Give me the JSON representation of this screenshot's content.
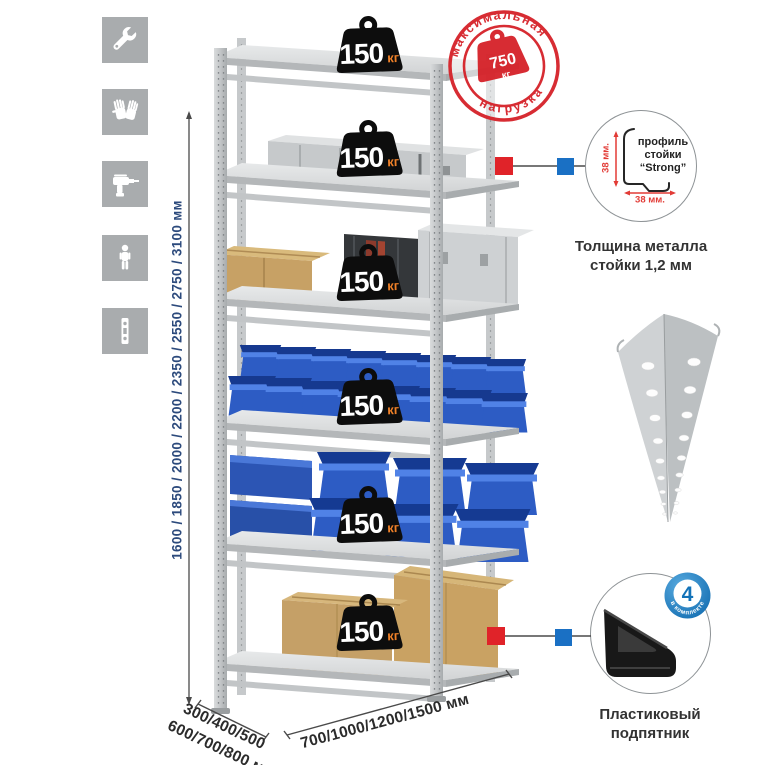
{
  "colors": {
    "accent-red": "#d6242b",
    "accent-blue": "#1a70c4",
    "dim-blue": "#2c4a7c",
    "badge-orange": "#f08128",
    "icon-gray": "#a9acae",
    "text-dark": "#333333"
  },
  "sidebar": {
    "icons": [
      "wrench",
      "gloves",
      "drill",
      "person-height",
      "perforated-profile"
    ]
  },
  "dimensions": {
    "height": "1600 / 1850 / 2000 / 2200 / 2350 / 2550 / 2750 / 3100 мм",
    "width": "700/1000/1200/1500 мм",
    "depth_line1": "300/400/500",
    "depth_line2": "600/700/800 мм"
  },
  "stamp": {
    "arc_top": "максимальная",
    "arc_bottom": "нагрузка",
    "weight_value": "750",
    "weight_unit": "кг"
  },
  "rack": {
    "shelf_loads": [
      {
        "value": "150",
        "unit": "кг"
      },
      {
        "value": "150",
        "unit": "кг"
      },
      {
        "value": "150",
        "unit": "кг"
      },
      {
        "value": "150",
        "unit": "кг"
      },
      {
        "value": "150",
        "unit": "кг"
      },
      {
        "value": "150",
        "unit": "кг"
      }
    ]
  },
  "profile_detail": {
    "label_line1": "профиль",
    "label_line2": "стойки",
    "label_line3": "“Strong”",
    "dim_vertical": "38 мм.",
    "dim_horizontal": "38 мм.",
    "caption_line1": "Толщина металла",
    "caption_line2": "стойки 1,2 мм"
  },
  "foot_detail": {
    "badge_value": "4",
    "badge_label": "в комплекте",
    "caption_line1": "Пластиковый",
    "caption_line2": "подпятник"
  }
}
